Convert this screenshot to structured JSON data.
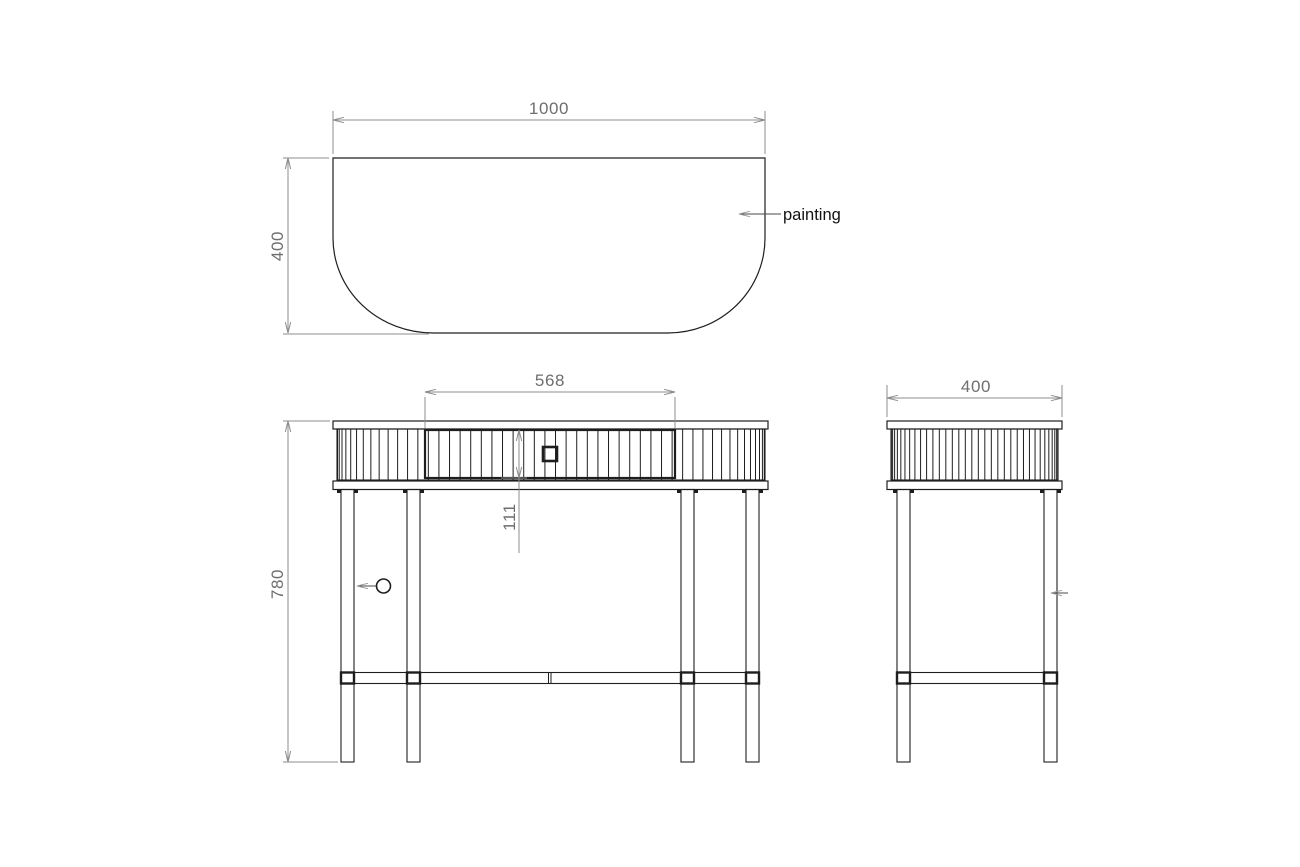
{
  "drawing": {
    "background": "#ffffff",
    "object_line_color": "#1e1e1e",
    "dimension_line_color": "#8c8c8c",
    "dimension_text_color": "#6e6e6e",
    "label_text_color": "#121212",
    "top_view": {
      "width_dim": "1000",
      "depth_dim": "400",
      "callout_label": "painting"
    },
    "front_view": {
      "drawer_width_dim": "568",
      "drawer_height_dim": "111",
      "height_dim": "780"
    },
    "side_view": {
      "depth_dim": "400"
    }
  }
}
